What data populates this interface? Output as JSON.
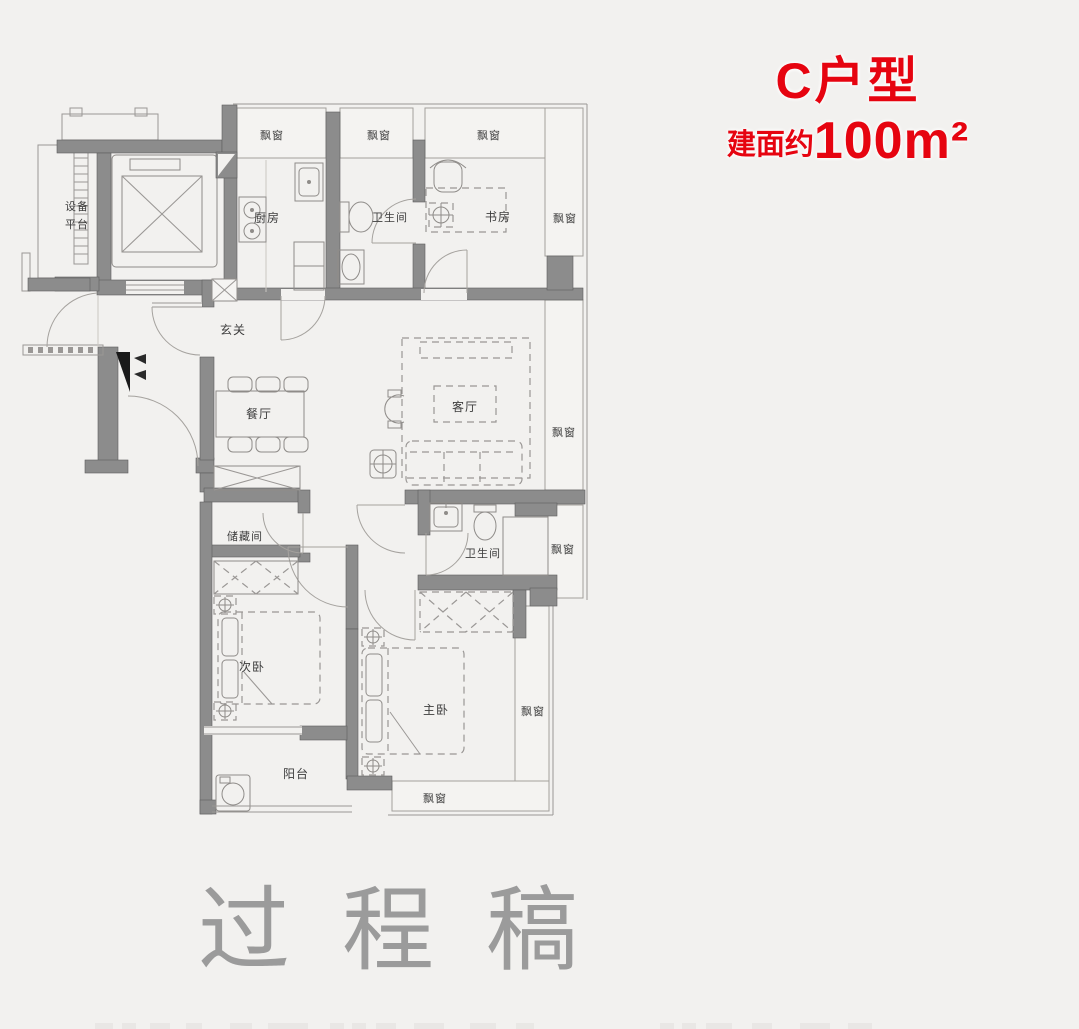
{
  "title": {
    "type_name": "C户型",
    "area_prefix": "建面约",
    "area_value": "100m²"
  },
  "watermark": {
    "text": "过程稿"
  },
  "rooms": {
    "equipment_platform_l1": "设备",
    "equipment_platform_l2": "平台",
    "kitchen": "厨房",
    "bathroom1": "卫生间",
    "study": "书房",
    "entry": "玄关",
    "dining": "餐厅",
    "living": "客厅",
    "storage": "储藏间",
    "bathroom2": "卫生间",
    "second_bedroom": "次卧",
    "master_bedroom": "主卧",
    "balcony": "阳台",
    "bay_window": "飘窗"
  },
  "colors": {
    "accent_red": "#e60410",
    "wall_gray": "#8c8c8c",
    "background": "#f2f1ef",
    "watermark_gray": "#9b9b9b",
    "label_gray": "#3d3d3d"
  }
}
